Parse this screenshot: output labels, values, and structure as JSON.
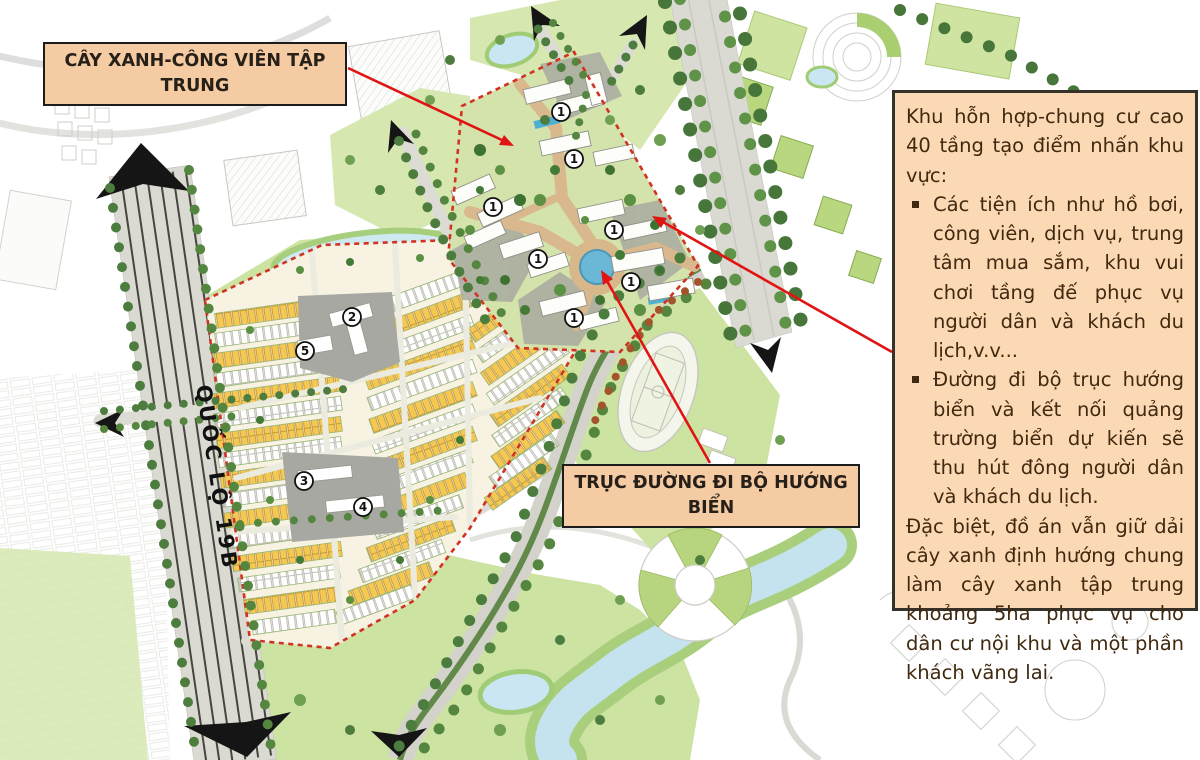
{
  "callouts": {
    "park": "CÂY XANH-CÔNG VIÊN TẬP TRUNG",
    "walkway": "TRỤC ĐƯỜNG ĐI BỘ HƯỚNG BIỂN"
  },
  "info_panel": {
    "intro": "Khu hỗn hợp-chung cư cao 40 tầng tạo điểm nhấn khu vực:",
    "bullets": [
      "Các tiện ích như hồ bơi, công viên, dịch vụ, trung tâm mua sắm, khu vui chơi tầng đế phục vụ người dân và khách du lịch,v.v...",
      "Đường đi bộ trục hướng biển và kết nối quảng trường biển dự kiến sẽ thu hút đông người dân và khách du lịch."
    ],
    "outro": "Đặc biệt, đồ án vẫn giữ dải cây xanh định hướng chung làm cây xanh tập trung khoảng 5ha phục vụ cho dân cư nội khu và một phần khách vãng lai."
  },
  "map": {
    "highway_label": "QUỐC LỘ 19B",
    "markers": [
      {
        "label": "1",
        "x": 561,
        "y": 112
      },
      {
        "label": "1",
        "x": 574,
        "y": 159
      },
      {
        "label": "1",
        "x": 493,
        "y": 207
      },
      {
        "label": "1",
        "x": 614,
        "y": 230
      },
      {
        "label": "1",
        "x": 538,
        "y": 259
      },
      {
        "label": "1",
        "x": 631,
        "y": 282
      },
      {
        "label": "1",
        "x": 574,
        "y": 318
      },
      {
        "label": "2",
        "x": 352,
        "y": 317
      },
      {
        "label": "5",
        "x": 305,
        "y": 351
      },
      {
        "label": "3",
        "x": 304,
        "y": 481
      },
      {
        "label": "4",
        "x": 363,
        "y": 507
      }
    ]
  },
  "colors": {
    "callout_bg": "#f5cba3",
    "callout_border": "#1c1c1c",
    "callout_text": "#272019",
    "panel_bg": "#fcd9b5",
    "panel_border": "#35322c",
    "panel_text": "#40290f",
    "arrow_red": "#e11414",
    "boundary_red": "#d03322",
    "highway_label_color": "#111111"
  }
}
